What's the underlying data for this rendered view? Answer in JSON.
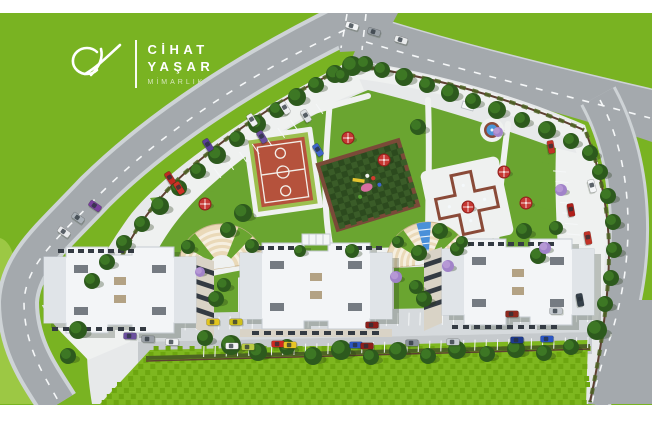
{
  "brand": {
    "monogram": "CY",
    "name_line1": "CİHAT",
    "name_line2": "YAŞAR",
    "tagline": "MİMARLIK"
  },
  "colors": {
    "white_bg": "#ffffff",
    "field": "#79b322",
    "field_light": "#9cc844",
    "road": "#a4a9ad",
    "road_casing": "#ced3d6",
    "road_line": "#f5f7f8",
    "paving": "#e7e9ea",
    "promenade": "#eff1f0",
    "apron": "#d6dadd",
    "road_minor": "#c6cacd",
    "lawn": "#6aa530",
    "grass_a": "#7eb71f",
    "grass_b": "#6da610",
    "hedge": "#4c6323",
    "fence": "#5d4031",
    "court": "#b5523c",
    "court_line": "#f3efe9",
    "court_apron": "#9cbf4e",
    "play_a": "#2c4a1e",
    "play_b": "#3a5c28",
    "play_border": "#7a4a38",
    "pool": "#4a95d8",
    "pool_edge": "#8a4a38",
    "cascade": "#4a90d9",
    "plaza_cream": "#ead9b8",
    "plaza_cream_light": "#f6efe0",
    "plaza_edge": "#cbb691",
    "building": "#f3f5f7",
    "building_edge": "#c6ccd2",
    "building_shade": "#e0e4e8",
    "roof_unit": "#757b82",
    "roof_tan": "#b3a284",
    "facade": "#d9d3c6",
    "window": "#343b43",
    "umbrella": "#c63732",
    "umbrella_dark": "#8e201c",
    "tree": "#2d5a1d",
    "tree_hi": "#3f7a26",
    "tree_purple": "#a183c9",
    "tree_purple_hi": "#b89ad6",
    "brand_sub": "#d7e7bd"
  },
  "scene": {
    "trees": [
      [
        335,
        74,
        9
      ],
      [
        316,
        85,
        8
      ],
      [
        297,
        97,
        9
      ],
      [
        277,
        110,
        8
      ],
      [
        257,
        124,
        9
      ],
      [
        237,
        139,
        8
      ],
      [
        217,
        155,
        9
      ],
      [
        198,
        171,
        8
      ],
      [
        179,
        188,
        8
      ],
      [
        160,
        206,
        9
      ],
      [
        142,
        224,
        8
      ],
      [
        124,
        243,
        8
      ],
      [
        107,
        262,
        8
      ],
      [
        92,
        281,
        8
      ],
      [
        78,
        330,
        9
      ],
      [
        68,
        356,
        8
      ],
      [
        352,
        66,
        10
      ],
      [
        342,
        76,
        7
      ],
      [
        365,
        64,
        8
      ],
      [
        382,
        70,
        8
      ],
      [
        404,
        77,
        9
      ],
      [
        427,
        85,
        8
      ],
      [
        450,
        93,
        9
      ],
      [
        473,
        101,
        8
      ],
      [
        497,
        110,
        9
      ],
      [
        522,
        120,
        8
      ],
      [
        547,
        130,
        9
      ],
      [
        571,
        141,
        8
      ],
      [
        590,
        153,
        8
      ],
      [
        600,
        172,
        8
      ],
      [
        608,
        196,
        8
      ],
      [
        613,
        222,
        8
      ],
      [
        614,
        250,
        8
      ],
      [
        611,
        278,
        8
      ],
      [
        605,
        304,
        8
      ],
      [
        597,
        330,
        10
      ],
      [
        243,
        213,
        9
      ],
      [
        228,
        230,
        8
      ],
      [
        418,
        127,
        8
      ],
      [
        440,
        231,
        8
      ],
      [
        419,
        253,
        8
      ],
      [
        457,
        249,
        7
      ],
      [
        538,
        256,
        8
      ],
      [
        524,
        231,
        8
      ],
      [
        556,
        228,
        7
      ],
      [
        352,
        251,
        7
      ],
      [
        300,
        251,
        6
      ],
      [
        188,
        247,
        7
      ],
      [
        252,
        246,
        7
      ],
      [
        398,
        242,
        6
      ],
      [
        462,
        242,
        6
      ],
      [
        216,
        299,
        8
      ],
      [
        224,
        285,
        7
      ],
      [
        424,
        299,
        8
      ],
      [
        416,
        287,
        7
      ],
      [
        205,
        338,
        8
      ],
      [
        231,
        345,
        10
      ],
      [
        258,
        352,
        9
      ],
      [
        287,
        347,
        8
      ],
      [
        313,
        356,
        9
      ],
      [
        341,
        350,
        10
      ],
      [
        371,
        357,
        8
      ],
      [
        398,
        351,
        9
      ],
      [
        428,
        356,
        8
      ],
      [
        457,
        350,
        9
      ],
      [
        487,
        354,
        8
      ],
      [
        516,
        349,
        9
      ],
      [
        544,
        353,
        8
      ],
      [
        571,
        347,
        8
      ]
    ],
    "purple_trees": [
      [
        561,
        190,
        6
      ],
      [
        545,
        248,
        6
      ],
      [
        448,
        266,
        6
      ],
      [
        396,
        277,
        6
      ],
      [
        200,
        272,
        5
      ],
      [
        498,
        132,
        5
      ]
    ],
    "umbrellas": [
      [
        348,
        138
      ],
      [
        384,
        160
      ],
      [
        205,
        204
      ],
      [
        504,
        172
      ],
      [
        468,
        207
      ],
      [
        526,
        203
      ]
    ],
    "cars": [
      [
        352,
        26,
        17,
        "#f3f5f6"
      ],
      [
        374,
        32,
        17,
        "#9aa1a7"
      ],
      [
        401,
        40,
        17,
        "#e9ebec"
      ],
      [
        592,
        186,
        75,
        "#f5f7f8"
      ],
      [
        551,
        147,
        80,
        "#c23227"
      ],
      [
        571,
        210,
        80,
        "#b01e19"
      ],
      [
        588,
        238,
        80,
        "#c23227"
      ],
      [
        580,
        300,
        80,
        "#35404a"
      ],
      [
        130,
        336,
        2,
        "#6b4f9e"
      ],
      [
        148,
        339,
        2,
        "#9aa0a6"
      ],
      [
        172,
        342,
        2,
        "#f0f2f3"
      ],
      [
        213,
        322,
        0,
        "#e3c51f"
      ],
      [
        236,
        322,
        0,
        "#cfc01a"
      ],
      [
        372,
        325,
        0,
        "#8f1f1a"
      ],
      [
        512,
        314,
        0,
        "#90291e"
      ],
      [
        556,
        311,
        0,
        "#c3c9ce"
      ],
      [
        232,
        346,
        0,
        "#f2f3f4"
      ],
      [
        248,
        347,
        0,
        "#bacb42"
      ],
      [
        278,
        344,
        0,
        "#d02820"
      ],
      [
        290,
        345,
        0,
        "#e8c623"
      ],
      [
        356,
        345,
        0,
        "#2b56c4"
      ],
      [
        367,
        346,
        0,
        "#8f1f1a"
      ],
      [
        412,
        343,
        0,
        "#8a929a"
      ],
      [
        453,
        342,
        0,
        "#c6ccd1"
      ],
      [
        517,
        340,
        0,
        "#1d3a8f"
      ],
      [
        547,
        339,
        0,
        "#2b56c4"
      ],
      [
        95,
        206,
        35,
        "#7a3f9e"
      ],
      [
        78,
        218,
        35,
        "#aab2b8"
      ],
      [
        64,
        232,
        35,
        "#e9ebed"
      ],
      [
        170,
        178,
        58,
        "#c02a22"
      ],
      [
        179,
        188,
        58,
        "#cd3226"
      ],
      [
        208,
        145,
        58,
        "#5a3f9b"
      ],
      [
        262,
        137,
        58,
        "#6b4f9e"
      ],
      [
        285,
        108,
        58,
        "#eef0f2"
      ],
      [
        306,
        116,
        58,
        "#dfe3e5"
      ],
      [
        318,
        150,
        58,
        "#3f66c9"
      ],
      [
        252,
        120,
        58,
        "#f0f1f3"
      ]
    ],
    "stall_rows": [
      {
        "x1": 152,
        "y1": 318,
        "x2": 588,
        "y2": 309,
        "count": 40,
        "len": 13,
        "angle": 92
      },
      {
        "x1": 204,
        "y1": 346,
        "x2": 588,
        "y2": 337,
        "count": 35,
        "len": 11,
        "angle": 92
      },
      {
        "x1": 566,
        "y1": 172,
        "x2": 594,
        "y2": 298,
        "count": 13,
        "len": 13,
        "angle": 185
      },
      {
        "x1": 214,
        "y1": 168,
        "x2": 316,
        "y2": 104,
        "count": 9,
        "len": 12,
        "angle": 55
      }
    ],
    "window_rows": [
      {
        "x": 58,
        "y": 249,
        "count": 8,
        "gap": 10,
        "w": 6,
        "h": 4
      },
      {
        "x": 458,
        "y": 242,
        "count": 10,
        "gap": 10,
        "w": 6,
        "h": 4
      },
      {
        "x": 248,
        "y": 246,
        "count": 5,
        "gap": 10,
        "w": 6,
        "h": 4
      },
      {
        "x": 336,
        "y": 246,
        "count": 5,
        "gap": 10,
        "w": 6,
        "h": 4
      },
      {
        "x": 252,
        "y": 331,
        "count": 11,
        "gap": 12,
        "w": 7,
        "h": 4
      },
      {
        "x": 52,
        "y": 327,
        "count": 9,
        "gap": 11,
        "w": 6,
        "h": 4
      },
      {
        "x": 452,
        "y": 325,
        "count": 10,
        "gap": 11,
        "w": 6,
        "h": 4
      }
    ],
    "plazas": [
      {
        "x": 222,
        "y": 268,
        "rot": -8,
        "r": 44,
        "cascade": false
      },
      {
        "x": 428,
        "y": 264,
        "rot": -6,
        "r": 42,
        "cascade": true
      }
    ],
    "grass_tex": {
      "y0": 346,
      "y1": 402,
      "step": 6,
      "left_base": 100,
      "left_slope": 0.85,
      "right": 586
    },
    "play_checker": {
      "hw": 40,
      "hh": 32,
      "cell": 6
    }
  }
}
